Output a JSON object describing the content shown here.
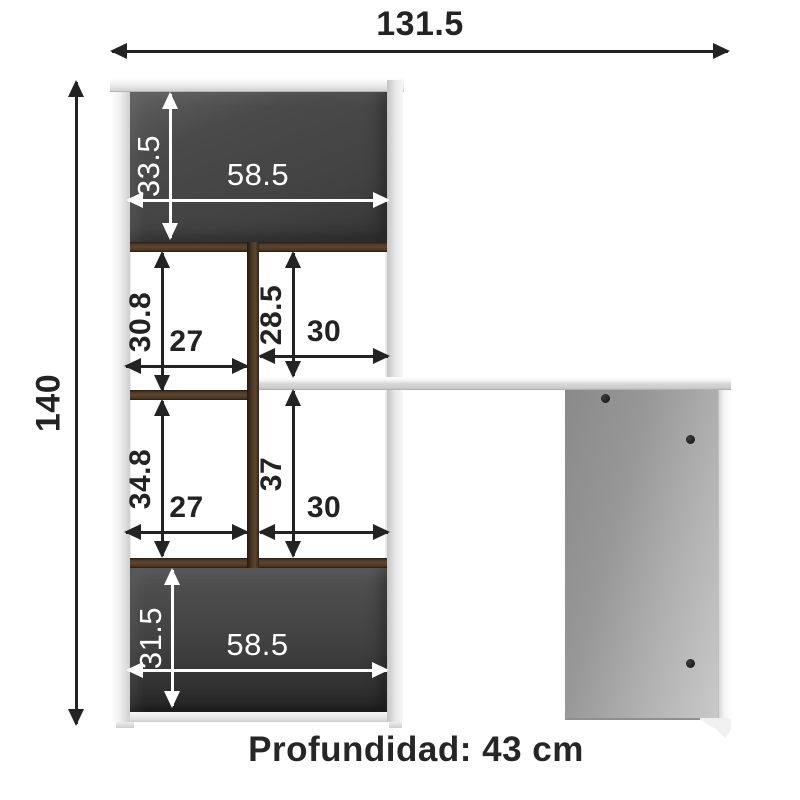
{
  "diagram": {
    "overall": {
      "width": "131.5",
      "height": "140"
    },
    "cells": {
      "top": {
        "height": "33.5",
        "width": "58.5"
      },
      "upper_left": {
        "height": "30.8",
        "width": "27"
      },
      "upper_right": {
        "height": "28.5",
        "width": "30"
      },
      "lower_left": {
        "height": "34.8",
        "width": "27"
      },
      "lower_right": {
        "height": "37",
        "width": "30"
      },
      "bottom": {
        "height": "31.5",
        "width": "58.5"
      }
    },
    "footer": {
      "depth": "Profundidad: 43 cm"
    },
    "colors": {
      "dimension_black": "#232323",
      "dimension_white": "#ffffff",
      "wood": "#5b4430",
      "back_panel": "#424242",
      "frame_white": "#f2f2f2",
      "desk_side_gray": "#a8a8a8"
    }
  }
}
